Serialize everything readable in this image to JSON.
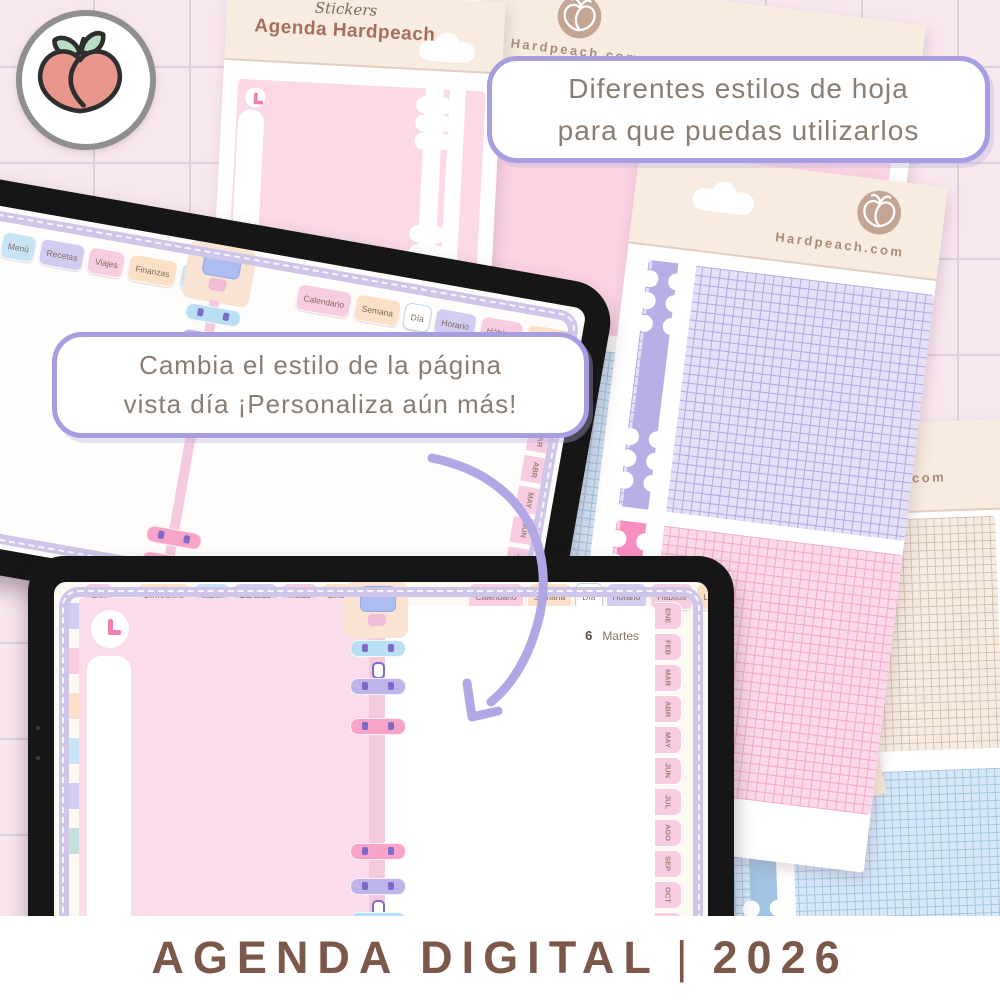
{
  "palette": {
    "bg": "#f9e7ef",
    "grid-line": "#ddd0d8",
    "bezel": "#161616",
    "cream": "#f7ecdf",
    "cream-2": "#f9e4d3",
    "title-brown": "#a86e5d",
    "script-brown": "#7f6a5d",
    "site-brown": "#a98d79",
    "bubble-border": "#a79ee2",
    "bubble-text": "#8a7d72",
    "tab-pink": "#f8cce1",
    "tab-peach": "#fbdfc7",
    "tab-blue": "#c9e3f6",
    "tab-lavender": "#d2ccf1",
    "tab-teal": "#c5dfdb",
    "tab-text": "#7f6b5f",
    "page-pink": "#fbdcea",
    "spine-pink": "#f5cade",
    "ring-blue": "#b9dff2",
    "ring-lavender": "#beb4ea",
    "ring-pink": "#f8a3c8",
    "ring-detail": "#7e6bc7",
    "grid-purple-bg": "#e4e0f8",
    "grid-purple-line": "#b3a7e0",
    "strip-lavender": "#b9aee6",
    "grid-pink-bg": "#fcd9e8",
    "grid-pink-line": "#f2a8ca",
    "strip-pink": "#f78fc0",
    "grid-blue-bg": "#d6e8f7",
    "grid-blue-line": "#a4c4de",
    "strip-blue": "#a2c4e3",
    "grid-tan-bg": "#f6ece2",
    "grid-tan-line": "#d4bfae",
    "arrow": "#b2a7e5",
    "banner-text": "#7b584a",
    "peach-body": "#e9968c",
    "peach-leaf": "#b8dfc4",
    "peach-outline": "#2e2e2e",
    "logo-ring": "#8f8f8f",
    "logo-badge": "#c4a492",
    "clock-pink": "#f27fb1",
    "clip-blue": "#aebdf0",
    "clip-pink": "#f3bcd6"
  },
  "banner": {
    "title": "AGENDA DIGITAL",
    "separator": "|",
    "year": "2026"
  },
  "bubbles": {
    "styles_line1": "Diferentes estilos de hoja",
    "styles_line2": "para que puedas utilizarlos",
    "custom_line1": "Cambia el estilo de la página",
    "custom_line2": "vista día ¡Personaliza aún más!"
  },
  "sheets": {
    "front": {
      "subtitle": "Stickers",
      "title": "Agenda Hardpeach"
    },
    "back_top": {
      "site": "Hardpeach.com"
    },
    "right": {
      "site": "Hardpeach.com"
    },
    "back_bottom": {
      "site_partial": "h.com"
    }
  },
  "tablet1": {
    "tabs_left": [
      {
        "label": "Menú",
        "color": "blue"
      },
      {
        "label": "Recetas",
        "color": "lavender"
      },
      {
        "label": "Viajes",
        "color": "pink"
      },
      {
        "label": "Finanzas",
        "color": "peach"
      },
      {
        "label": "Notas",
        "color": "blue"
      }
    ],
    "tabs_right": [
      {
        "label": "Calendario",
        "color": "pink"
      },
      {
        "label": "Semana",
        "color": "peach"
      },
      {
        "label": "Día",
        "color": "white"
      },
      {
        "label": "Horario",
        "color": "lavender"
      },
      {
        "label": "Hábitos",
        "color": "pink"
      },
      {
        "label": "Limpieza",
        "color": "peach"
      },
      {
        "label": "Extra",
        "color": "blue"
      }
    ],
    "selected_tab": "Día",
    "month_tabs": [
      {
        "label": "ENE",
        "color": "white"
      },
      {
        "label": "FEB",
        "color": "pink"
      },
      {
        "label": "MAR",
        "color": "pink"
      },
      {
        "label": "ABR",
        "color": "pink"
      },
      {
        "label": "MAY",
        "color": "pink"
      },
      {
        "label": "JUN",
        "color": "pink"
      },
      {
        "label": "JUL",
        "color": "pink"
      }
    ]
  },
  "tablet2": {
    "tab_year": [
      {
        "label": "Año",
        "color": "pink"
      }
    ],
    "tabs_left": [
      {
        "label": "Propósitos",
        "color": "peach"
      },
      {
        "label": "Menú",
        "color": "blue"
      },
      {
        "label": "Recetas",
        "color": "lavender"
      },
      {
        "label": "Viajes",
        "color": "pink"
      },
      {
        "label": "Finanzas",
        "color": "peach"
      },
      {
        "label": "Notas",
        "color": "blue"
      }
    ],
    "tabs_right": [
      {
        "label": "Calendario",
        "color": "pink"
      },
      {
        "label": "Semana",
        "color": "peach"
      },
      {
        "label": "Día",
        "color": "white"
      },
      {
        "label": "Horario",
        "color": "lavender"
      },
      {
        "label": "Hábitos",
        "color": "pink"
      },
      {
        "label": "Limpieza",
        "color": "peach"
      },
      {
        "label": "Extra",
        "color": "blue"
      }
    ],
    "selected_tab": "Día",
    "day_number": "6",
    "day_name": "Martes",
    "month_tabs": [
      {
        "label": "ENE",
        "color": "white"
      },
      {
        "label": "FEB",
        "color": "pink"
      },
      {
        "label": "MAR",
        "color": "pink"
      },
      {
        "label": "ABR",
        "color": "pink"
      },
      {
        "label": "MAY",
        "color": "pink"
      },
      {
        "label": "JUN",
        "color": "pink"
      },
      {
        "label": "JUL",
        "color": "pink"
      },
      {
        "label": "AGO",
        "color": "pink"
      },
      {
        "label": "SEP",
        "color": "pink"
      },
      {
        "label": "OCT",
        "color": "pink"
      },
      {
        "label": "NOV",
        "color": "pink"
      },
      {
        "label": "DIC",
        "color": "pink"
      }
    ],
    "selected_month": "ENE",
    "sticker_tabs": [
      {
        "color": "lavender"
      },
      {
        "color": "pink"
      },
      {
        "color": "peach"
      },
      {
        "color": "blue"
      },
      {
        "color": "lavender"
      },
      {
        "color": "teal"
      }
    ]
  }
}
